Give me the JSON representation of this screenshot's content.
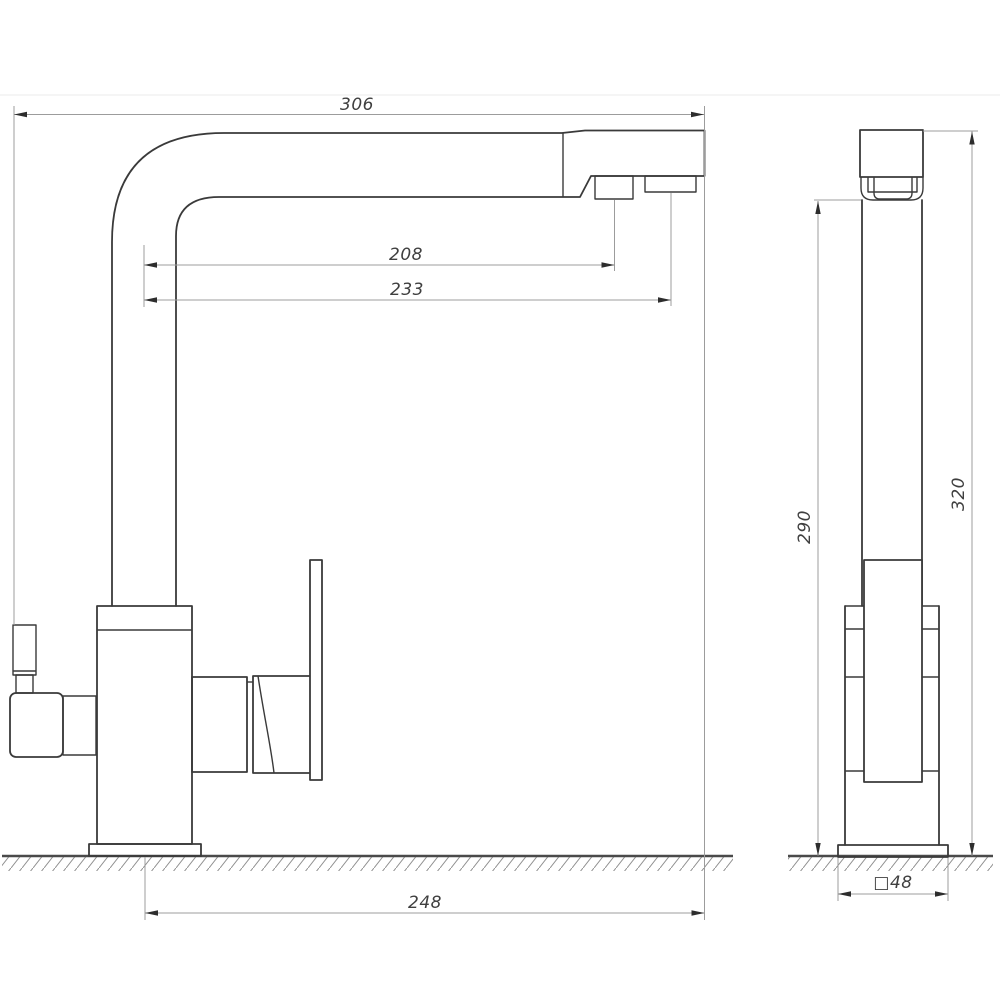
{
  "drawing": {
    "type": "technical-dimension-drawing",
    "subject": "kitchen-faucet-with-filter-channel-two-views",
    "views": {
      "left": "front-view",
      "right": "side-view"
    },
    "units_shown": "mm (implied)",
    "dimensions": {
      "overall_width": "306",
      "nozzle1_reach": "208",
      "nozzle2_reach": "233",
      "spout_end_offset_from_axis": "248",
      "height_under_spout": "290",
      "overall_height": "320",
      "base_section_square": "□48"
    },
    "colors": {
      "background": "#ffffff",
      "outline": "#3a3a3a",
      "dimension_line": "#9c9c9c",
      "arrowhead": "#2d2d2d",
      "text": "#3f3f3f"
    }
  }
}
